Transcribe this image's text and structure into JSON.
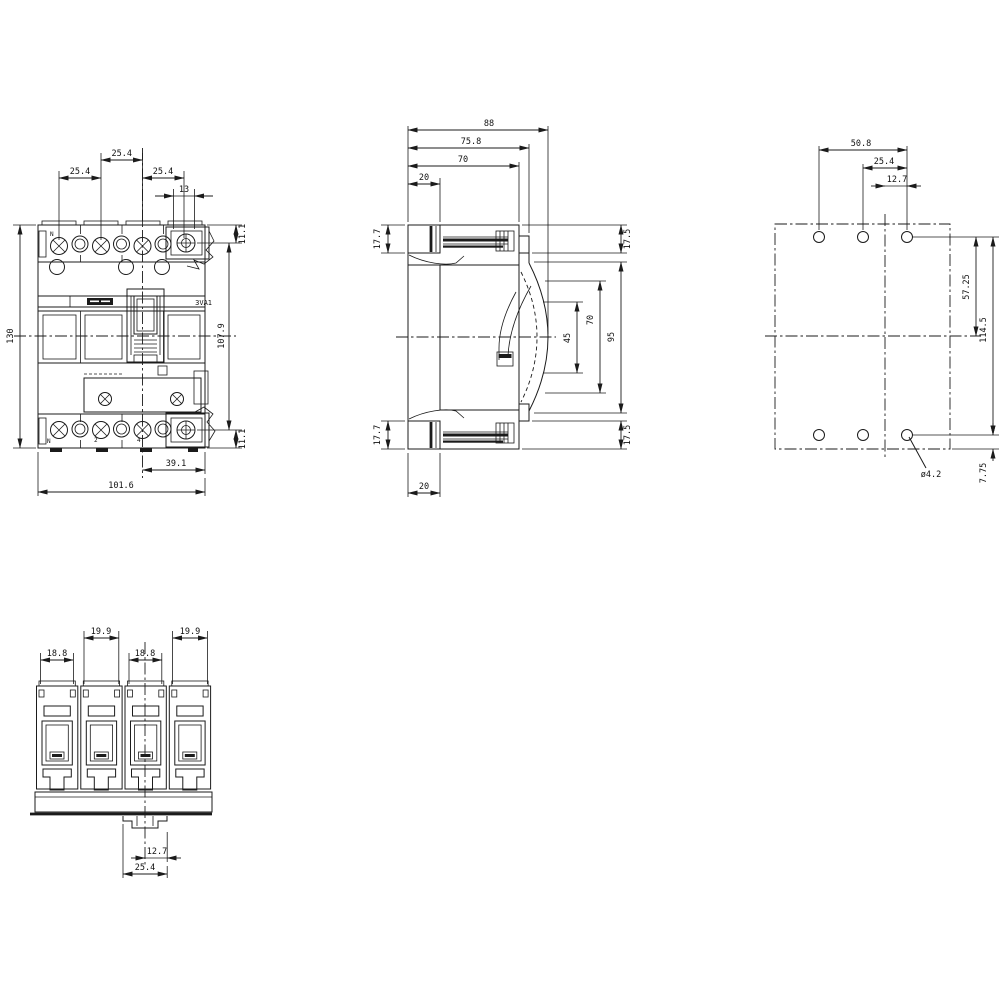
{
  "product": {
    "series_label": "3VA1"
  },
  "front": {
    "pole_labels": {
      "top_n": "N",
      "bottom_n": "N",
      "bottom_2": "2",
      "bottom_4": "4"
    },
    "dims": {
      "pitch_center": "25.4",
      "pitch_left": "25.4",
      "pitch_right": "25.4",
      "box_terminal_width": "13",
      "top_terminal_offset": "11.1",
      "terminal_span": "107.9",
      "bottom_terminal_offset": "11.1",
      "overall_height": "130",
      "neutral_to_edge": "39.1",
      "overall_width": "101.6"
    }
  },
  "side": {
    "dims": {
      "depth_overall": "88",
      "depth_to_cover": "75.8",
      "depth_to_case": "70",
      "busbar_depth_top": "20",
      "busbar_height_top": "17.7",
      "busbar_height_bottom": "17.7",
      "busbar_depth_bottom": "20",
      "clearance_top": "17.5",
      "window_small": "45",
      "window_mid": "70",
      "window_large": "95",
      "clearance_bottom": "17.5"
    }
  },
  "rear": {
    "dims": {
      "hole_span_outer": "50.8",
      "hole_span_mid": "25.4",
      "hole_offset_center": "12.7",
      "hole_to_centerline": "57.25",
      "hole_span_vertical": "114.5",
      "hole_to_edge": "7.75",
      "hole_diameter": "ø4.2"
    }
  },
  "bottom": {
    "dims": {
      "pole1_width": "18.8",
      "pole2_width": "19.9",
      "pole3_width": "18.8",
      "pole4_width": "19.9",
      "tab_half_width": "12.7",
      "tab_width": "25.4"
    }
  }
}
